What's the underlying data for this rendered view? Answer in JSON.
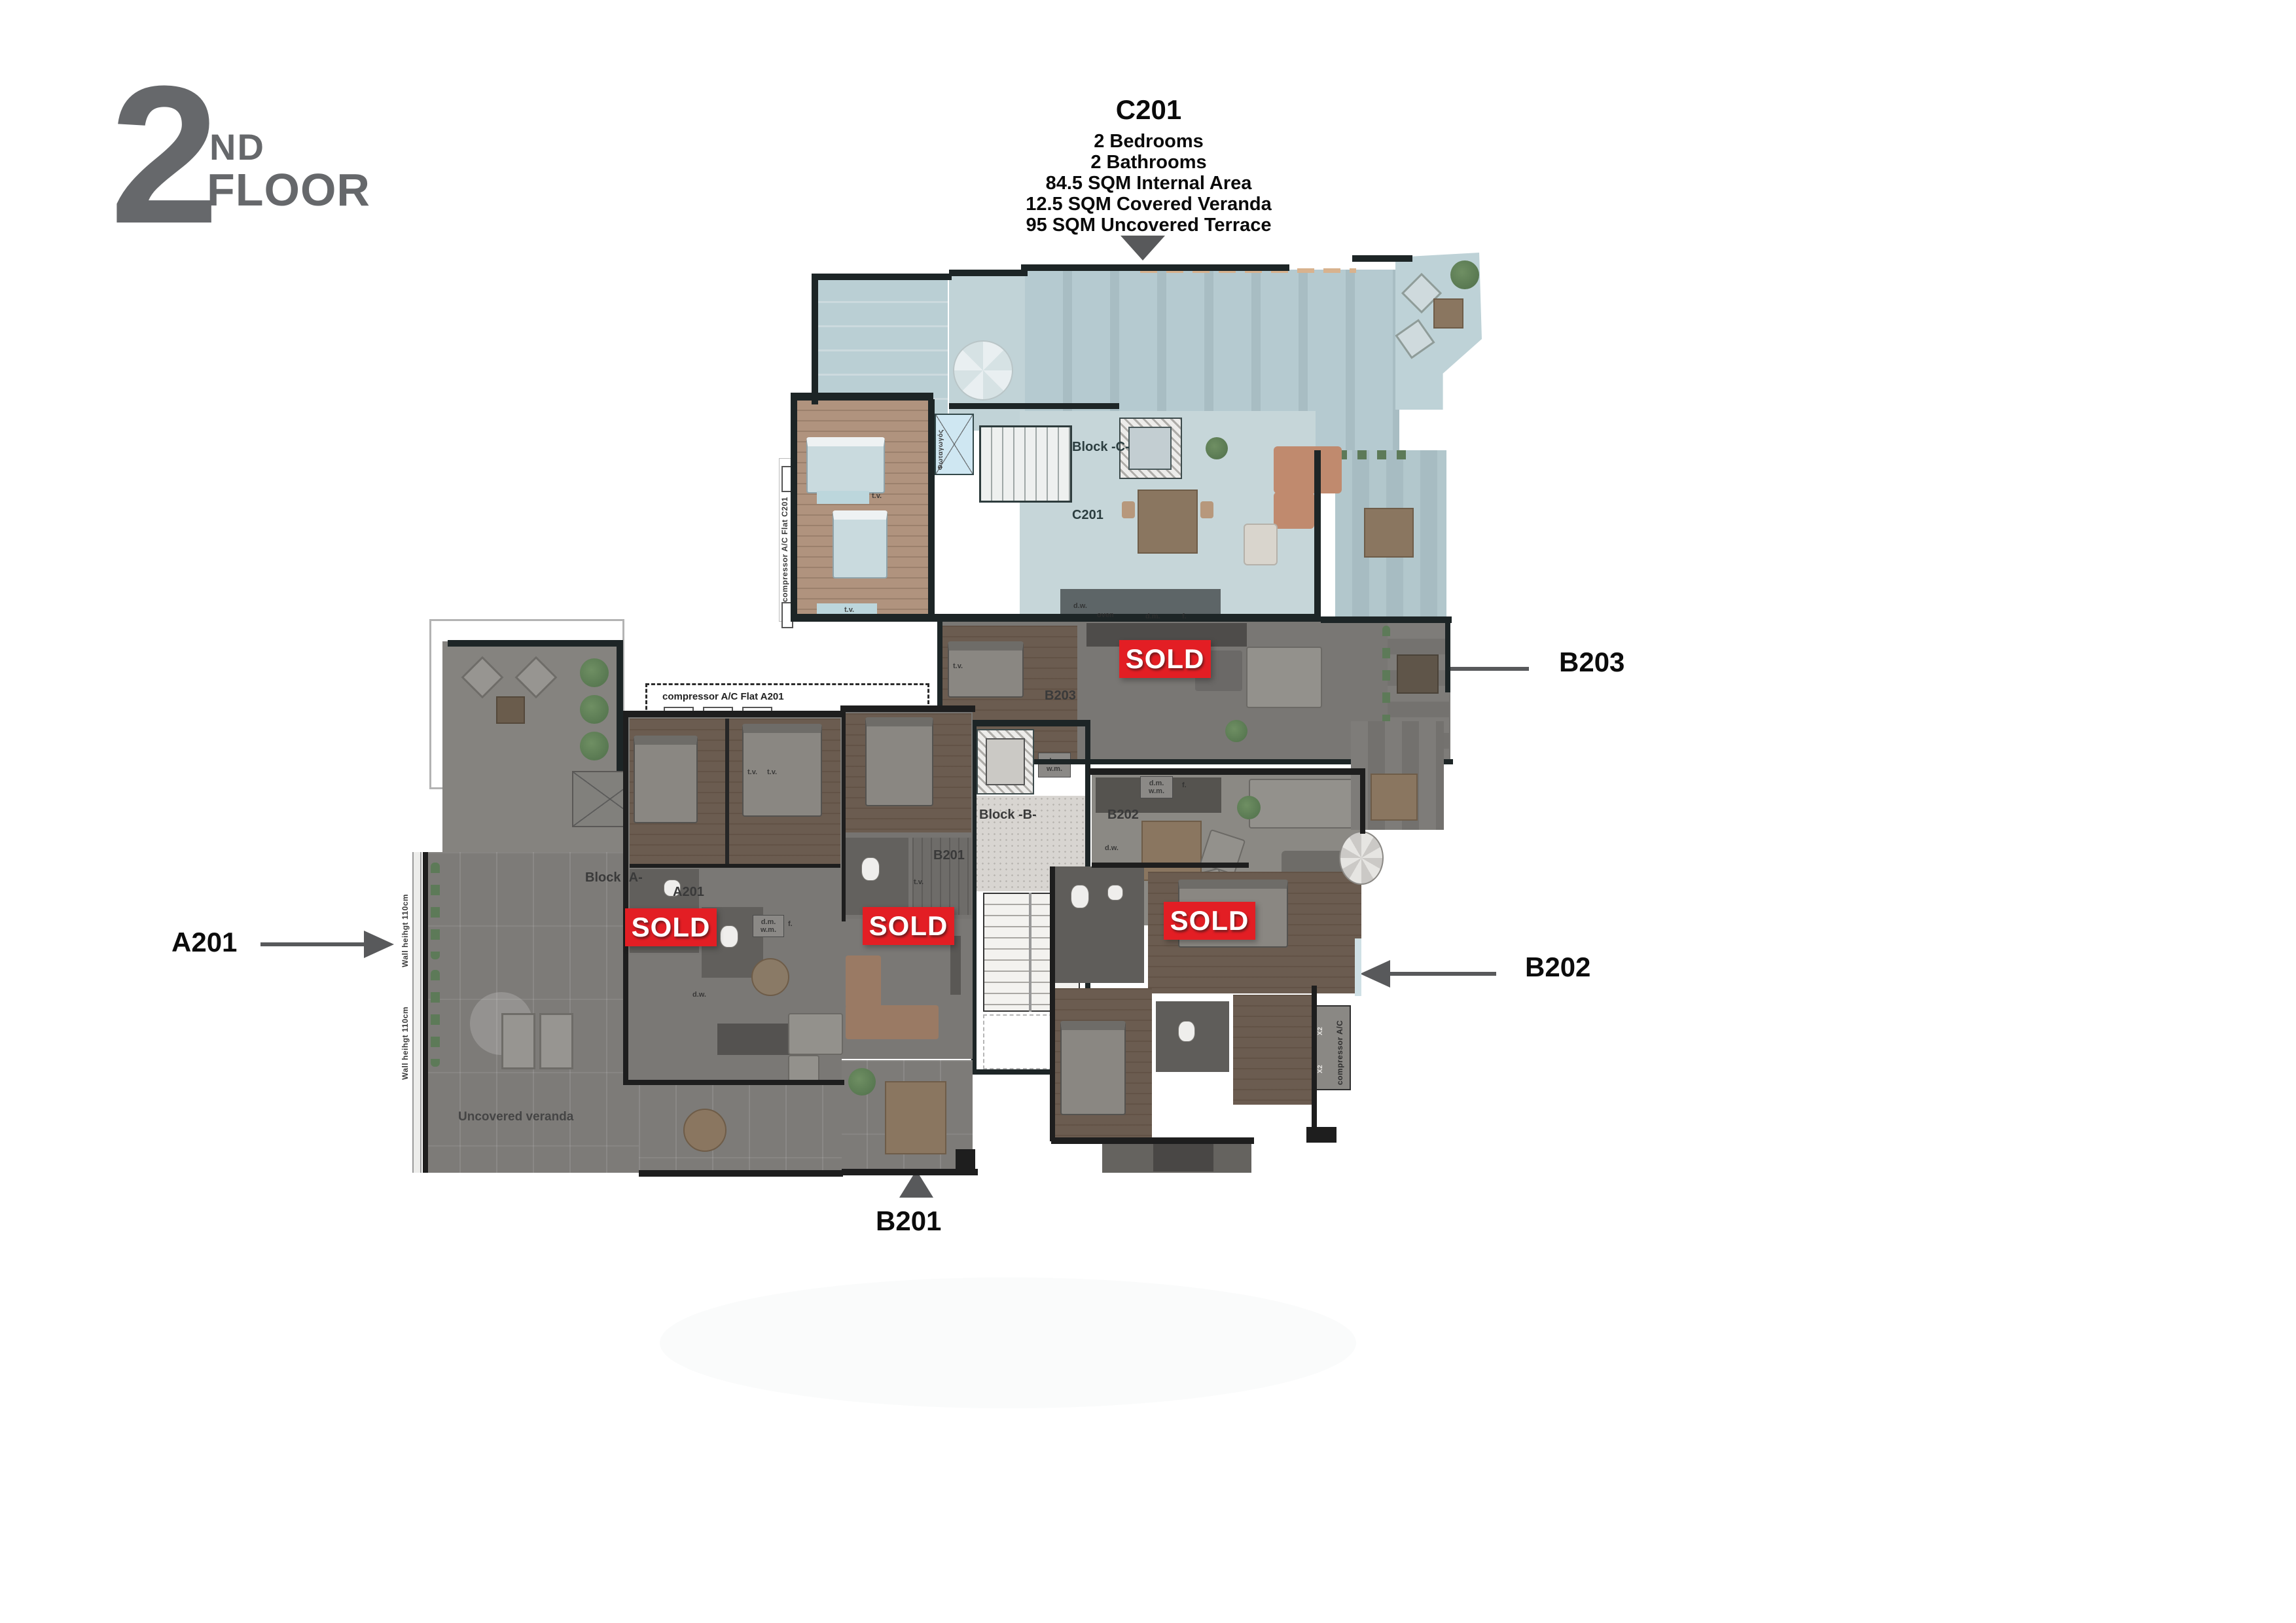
{
  "header": {
    "floor_number": "2",
    "floor_ordinal": "ND",
    "floor_word": "FLOOR"
  },
  "callout_c201": {
    "unit": "C201",
    "specs": [
      "2 Bedrooms",
      "2 Bathrooms",
      "84.5 SQM Internal Area",
      "12.5 SQM Covered Veranda",
      "95 SQM Uncovered Terrace"
    ]
  },
  "pointer_labels": {
    "a201": "A201",
    "b201": "B201",
    "b202": "B202",
    "b203": "B203"
  },
  "sold_badge_text": "SOLD",
  "plan_labels": {
    "block_a": "Block -A-",
    "block_b": "Block -B-",
    "block_c": "Block -C-",
    "unit_a201": "A201",
    "unit_b201": "B201",
    "unit_b202": "B202",
    "unit_b203": "B203",
    "unit_c201": "C201",
    "uncovered_veranda": "Uncovered veranda",
    "wall_height_note": "Wall heihgt 110cm",
    "compressor_flat_a201": "compressor A/C  Flat A201",
    "compressor_flat_c201": "compressor A/C Flat C201",
    "compressor_ac": "compressor A/C",
    "x2": "X2",
    "lightwell": "Φωταγωγός",
    "tv": "t.v.",
    "dw": "d.w.",
    "oven": "oven",
    "dm": "d.m.",
    "wm": "w.m.",
    "f": "f."
  },
  "colors": {
    "sold_red": "#e31e24",
    "arrow_gray": "#58595b",
    "logo_gray": "#66686b",
    "wall_dark": "#1d2526"
  }
}
